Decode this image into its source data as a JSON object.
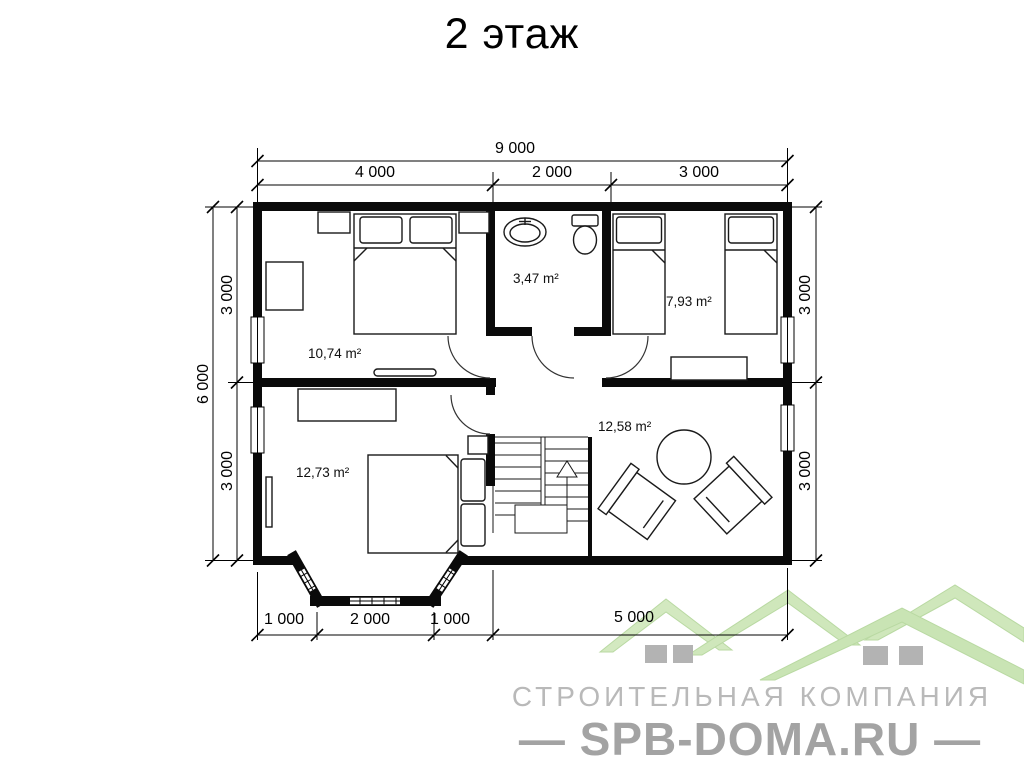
{
  "title": "2 этаж",
  "dims": {
    "top_total": "9 000",
    "top_segments": [
      "4 000",
      "2 000",
      "3 000"
    ],
    "left_total": "6 000",
    "left_segments": [
      "3 000",
      "3 000"
    ],
    "right_segments": [
      "3 000",
      "3 000"
    ],
    "bottom_segments": [
      "1 000",
      "2 000",
      "1 000",
      "5 000"
    ]
  },
  "rooms": [
    {
      "id": "bedroom-top-left",
      "area": "10,74 m²"
    },
    {
      "id": "bathroom",
      "area": "3,47 m²"
    },
    {
      "id": "bedroom-top-right",
      "area": "7,93 m²"
    },
    {
      "id": "bedroom-bottom-left",
      "area": "12,73 m²"
    },
    {
      "id": "living-hall",
      "area": "12,58 m²"
    }
  ],
  "fixtures": [
    "double-bed",
    "nightstand",
    "wardrobe",
    "tv",
    "sink",
    "toilet",
    "single-bed",
    "dresser",
    "stairs",
    "round-table",
    "armchair",
    "bay-window"
  ],
  "branding": {
    "company": "СТРОИТЕЛЬНАЯ КОМПАНИЯ",
    "site": "— SPB-DOMA.RU —"
  },
  "colors": {
    "walls": "#0a0a0a",
    "logo_green": "#cfe7bb",
    "logo_window_gray": "#b3b3b3",
    "company_text_gray": "#b9b9b9",
    "site_text_gray": "#a3a3a3"
  }
}
